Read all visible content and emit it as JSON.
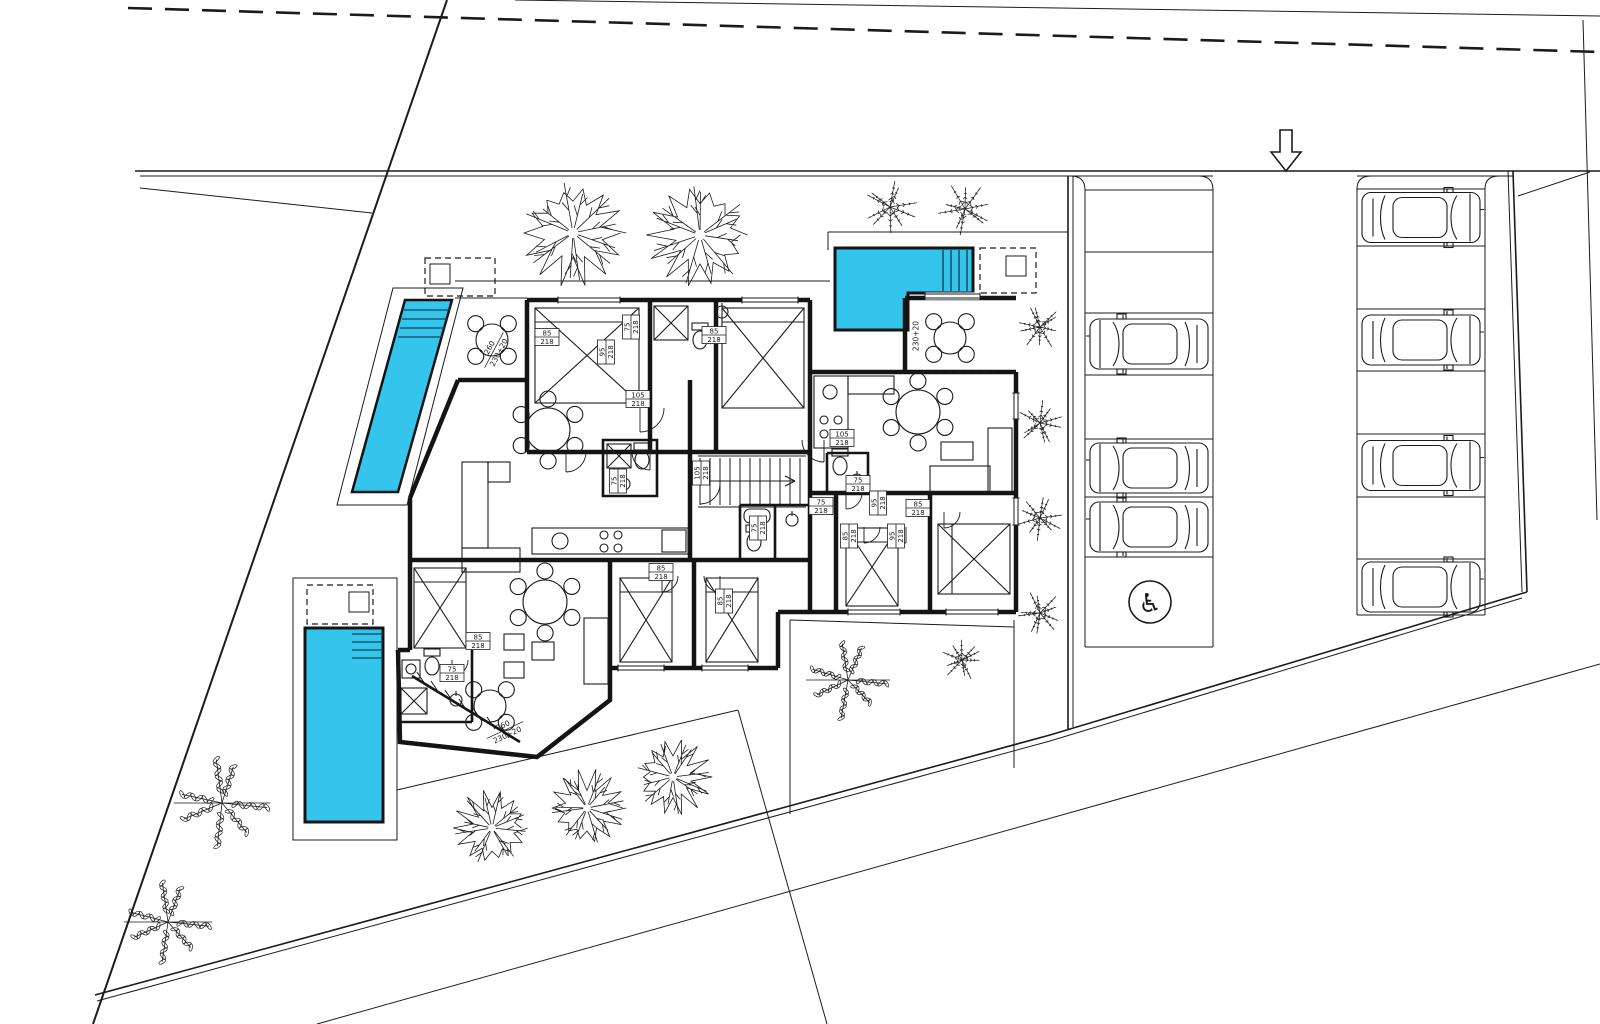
{
  "plan": {
    "colors": {
      "background": "#ffffff",
      "line": "#1b1b1b",
      "wall": "#141414",
      "pool_fill": "#35c5ec"
    },
    "icons": {
      "accessible_parking_symbol": "♿",
      "entrance_arrow": "down-arrow"
    },
    "pools": [
      {
        "id": "pool-northwest",
        "shape": "angled-lap-pool"
      },
      {
        "id": "pool-north",
        "shape": "l-shaped-pool-with-steps"
      },
      {
        "id": "pool-southwest",
        "shape": "lap-pool-with-steps"
      }
    ],
    "parking": {
      "middle_column": {
        "x": 1085,
        "width": 128,
        "row_lines": [
          190,
          252,
          313,
          375,
          439,
          497,
          557,
          647
        ],
        "cars_at_rows": [
          3,
          5,
          6
        ],
        "car_facing": "left",
        "accessible_row": 7
      },
      "right_column": {
        "x": 1357,
        "width": 128,
        "row_lines": [
          189,
          246,
          309,
          371,
          434,
          497,
          559,
          615
        ],
        "cars_at_rows": [
          1,
          3,
          5,
          7
        ],
        "car_facing": "right",
        "accessible_row": null
      },
      "accessible_badge": {
        "cx": 1150,
        "cy": 602,
        "r": 21
      }
    },
    "entrance_arrow": {
      "x": 1286,
      "y_top": 130,
      "y_tip": 171
    },
    "vegetation": {
      "deciduous_trees": [
        {
          "cx": 573,
          "cy": 233,
          "r": 52
        },
        {
          "cx": 700,
          "cy": 235,
          "r": 52
        },
        {
          "cx": 492,
          "cy": 828,
          "r": 38
        },
        {
          "cx": 587,
          "cy": 808,
          "r": 38
        },
        {
          "cx": 673,
          "cy": 777,
          "r": 38
        }
      ],
      "leafy_trees": [
        {
          "cx": 222,
          "cy": 803,
          "r": 46
        },
        {
          "cx": 168,
          "cy": 922,
          "r": 42
        },
        {
          "cx": 848,
          "cy": 680,
          "r": 40
        }
      ],
      "shrubs": [
        {
          "cx": 890,
          "cy": 207,
          "r": 26
        },
        {
          "cx": 965,
          "cy": 209,
          "r": 26
        },
        {
          "cx": 1040,
          "cy": 327,
          "r": 22
        },
        {
          "cx": 1040,
          "cy": 423,
          "r": 22
        },
        {
          "cx": 1040,
          "cy": 518,
          "r": 22
        },
        {
          "cx": 1040,
          "cy": 613,
          "r": 22
        },
        {
          "cx": 962,
          "cy": 660,
          "r": 20
        }
      ]
    },
    "door_tags": [
      {
        "num": "85",
        "den": "218",
        "x": 547,
        "y": 337,
        "rot": 0
      },
      {
        "num": "75",
        "den": "218",
        "x": 631,
        "y": 327,
        "rot": -90
      },
      {
        "num": "95",
        "den": "218",
        "x": 606,
        "y": 352,
        "rot": -90
      },
      {
        "num": "85",
        "den": "218",
        "x": 714,
        "y": 335,
        "rot": 0
      },
      {
        "num": "105",
        "den": "218",
        "x": 638,
        "y": 399,
        "rot": 0
      },
      {
        "num": "75",
        "den": "218",
        "x": 618,
        "y": 481,
        "rot": -90
      },
      {
        "num": "105",
        "den": "218",
        "x": 701,
        "y": 473,
        "rot": -90
      },
      {
        "num": "105",
        "den": "218",
        "x": 842,
        "y": 438,
        "rot": 0
      },
      {
        "num": "75",
        "den": "218",
        "x": 858,
        "y": 484,
        "rot": 0
      },
      {
        "num": "75",
        "den": "218",
        "x": 821,
        "y": 506,
        "rot": 0
      },
      {
        "num": "95",
        "den": "218",
        "x": 878,
        "y": 503,
        "rot": -90
      },
      {
        "num": "85",
        "den": "218",
        "x": 918,
        "y": 508,
        "rot": 0
      },
      {
        "num": "85",
        "den": "218",
        "x": 849,
        "y": 536,
        "rot": -90
      },
      {
        "num": "95",
        "den": "218",
        "x": 896,
        "y": 536,
        "rot": -90
      },
      {
        "num": "85",
        "den": "218",
        "x": 661,
        "y": 572,
        "rot": 0
      },
      {
        "num": "85",
        "den": "218",
        "x": 724,
        "y": 601,
        "rot": -90
      },
      {
        "num": "75",
        "den": "218",
        "x": 758,
        "y": 528,
        "rot": -90
      },
      {
        "num": "75",
        "den": "218",
        "x": 452,
        "y": 673,
        "rot": 0
      },
      {
        "num": "85",
        "den": "218",
        "x": 478,
        "y": 641,
        "rot": 0
      }
    ],
    "dimension_labels": [
      {
        "lines": [
          "260",
          "230+20"
        ],
        "x": 494,
        "y": 350,
        "rot": -62
      },
      {
        "lines": [
          "230+20"
        ],
        "x": 916,
        "y": 336,
        "rot": -90
      },
      {
        "lines": [
          "260",
          "230+20"
        ],
        "x": 505,
        "y": 730,
        "rot": -25
      }
    ]
  }
}
